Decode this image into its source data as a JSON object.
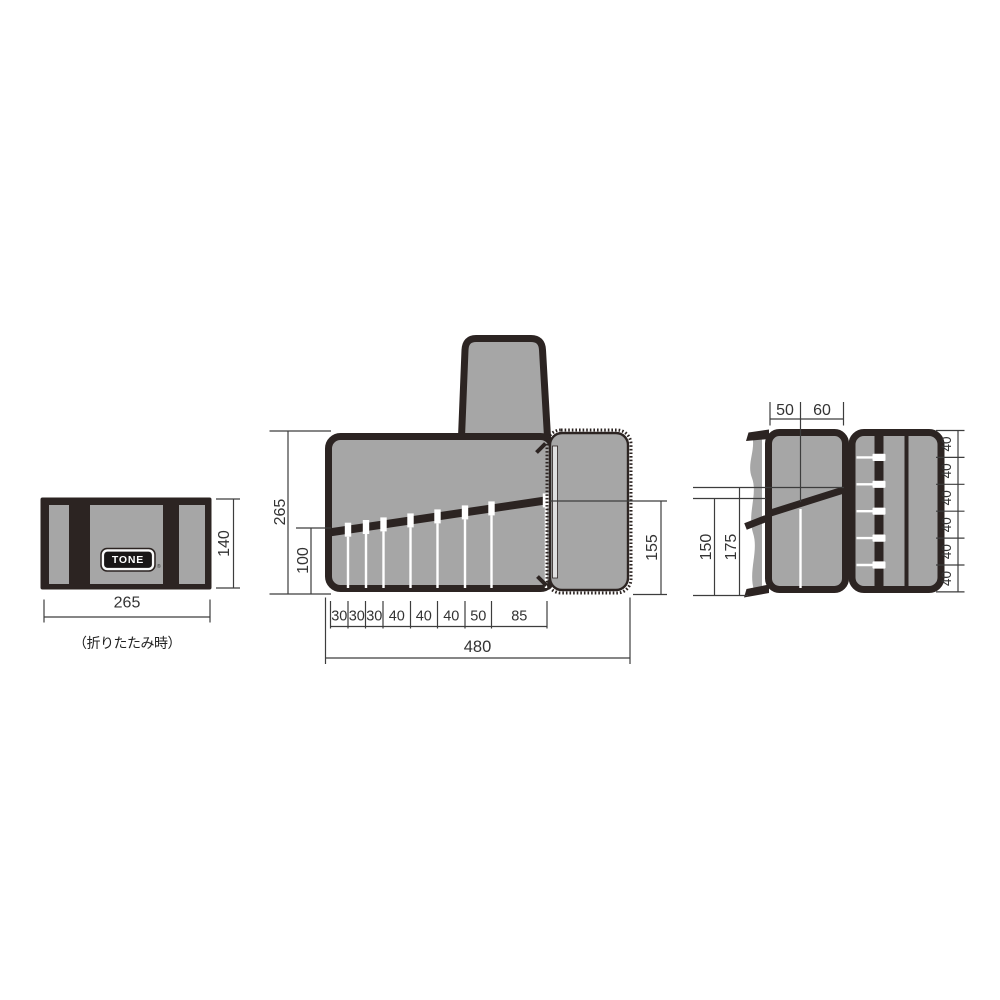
{
  "folded_view": {
    "logo": "TONE",
    "registered_mark": "®",
    "caption": "（折りたたみ時）",
    "width": "265",
    "height": "140"
  },
  "open_view": {
    "height": "265",
    "pocket_depth": "100",
    "flap_pocket_height": "155",
    "width": "480",
    "pocket_widths": [
      "30",
      "30",
      "30",
      "40",
      "40",
      "40",
      "50",
      "85"
    ]
  },
  "side_view": {
    "top_widths": [
      "50",
      "60"
    ],
    "heights": [
      "150",
      "175"
    ],
    "loop_spacings": [
      "40",
      "40",
      "40",
      "40",
      "40",
      "40"
    ]
  },
  "colors": {
    "fabric_dark": "#2c2422",
    "panel_gray": "#a6a6a6",
    "dimension_line": "#3d3d3d",
    "text": "#333333"
  }
}
